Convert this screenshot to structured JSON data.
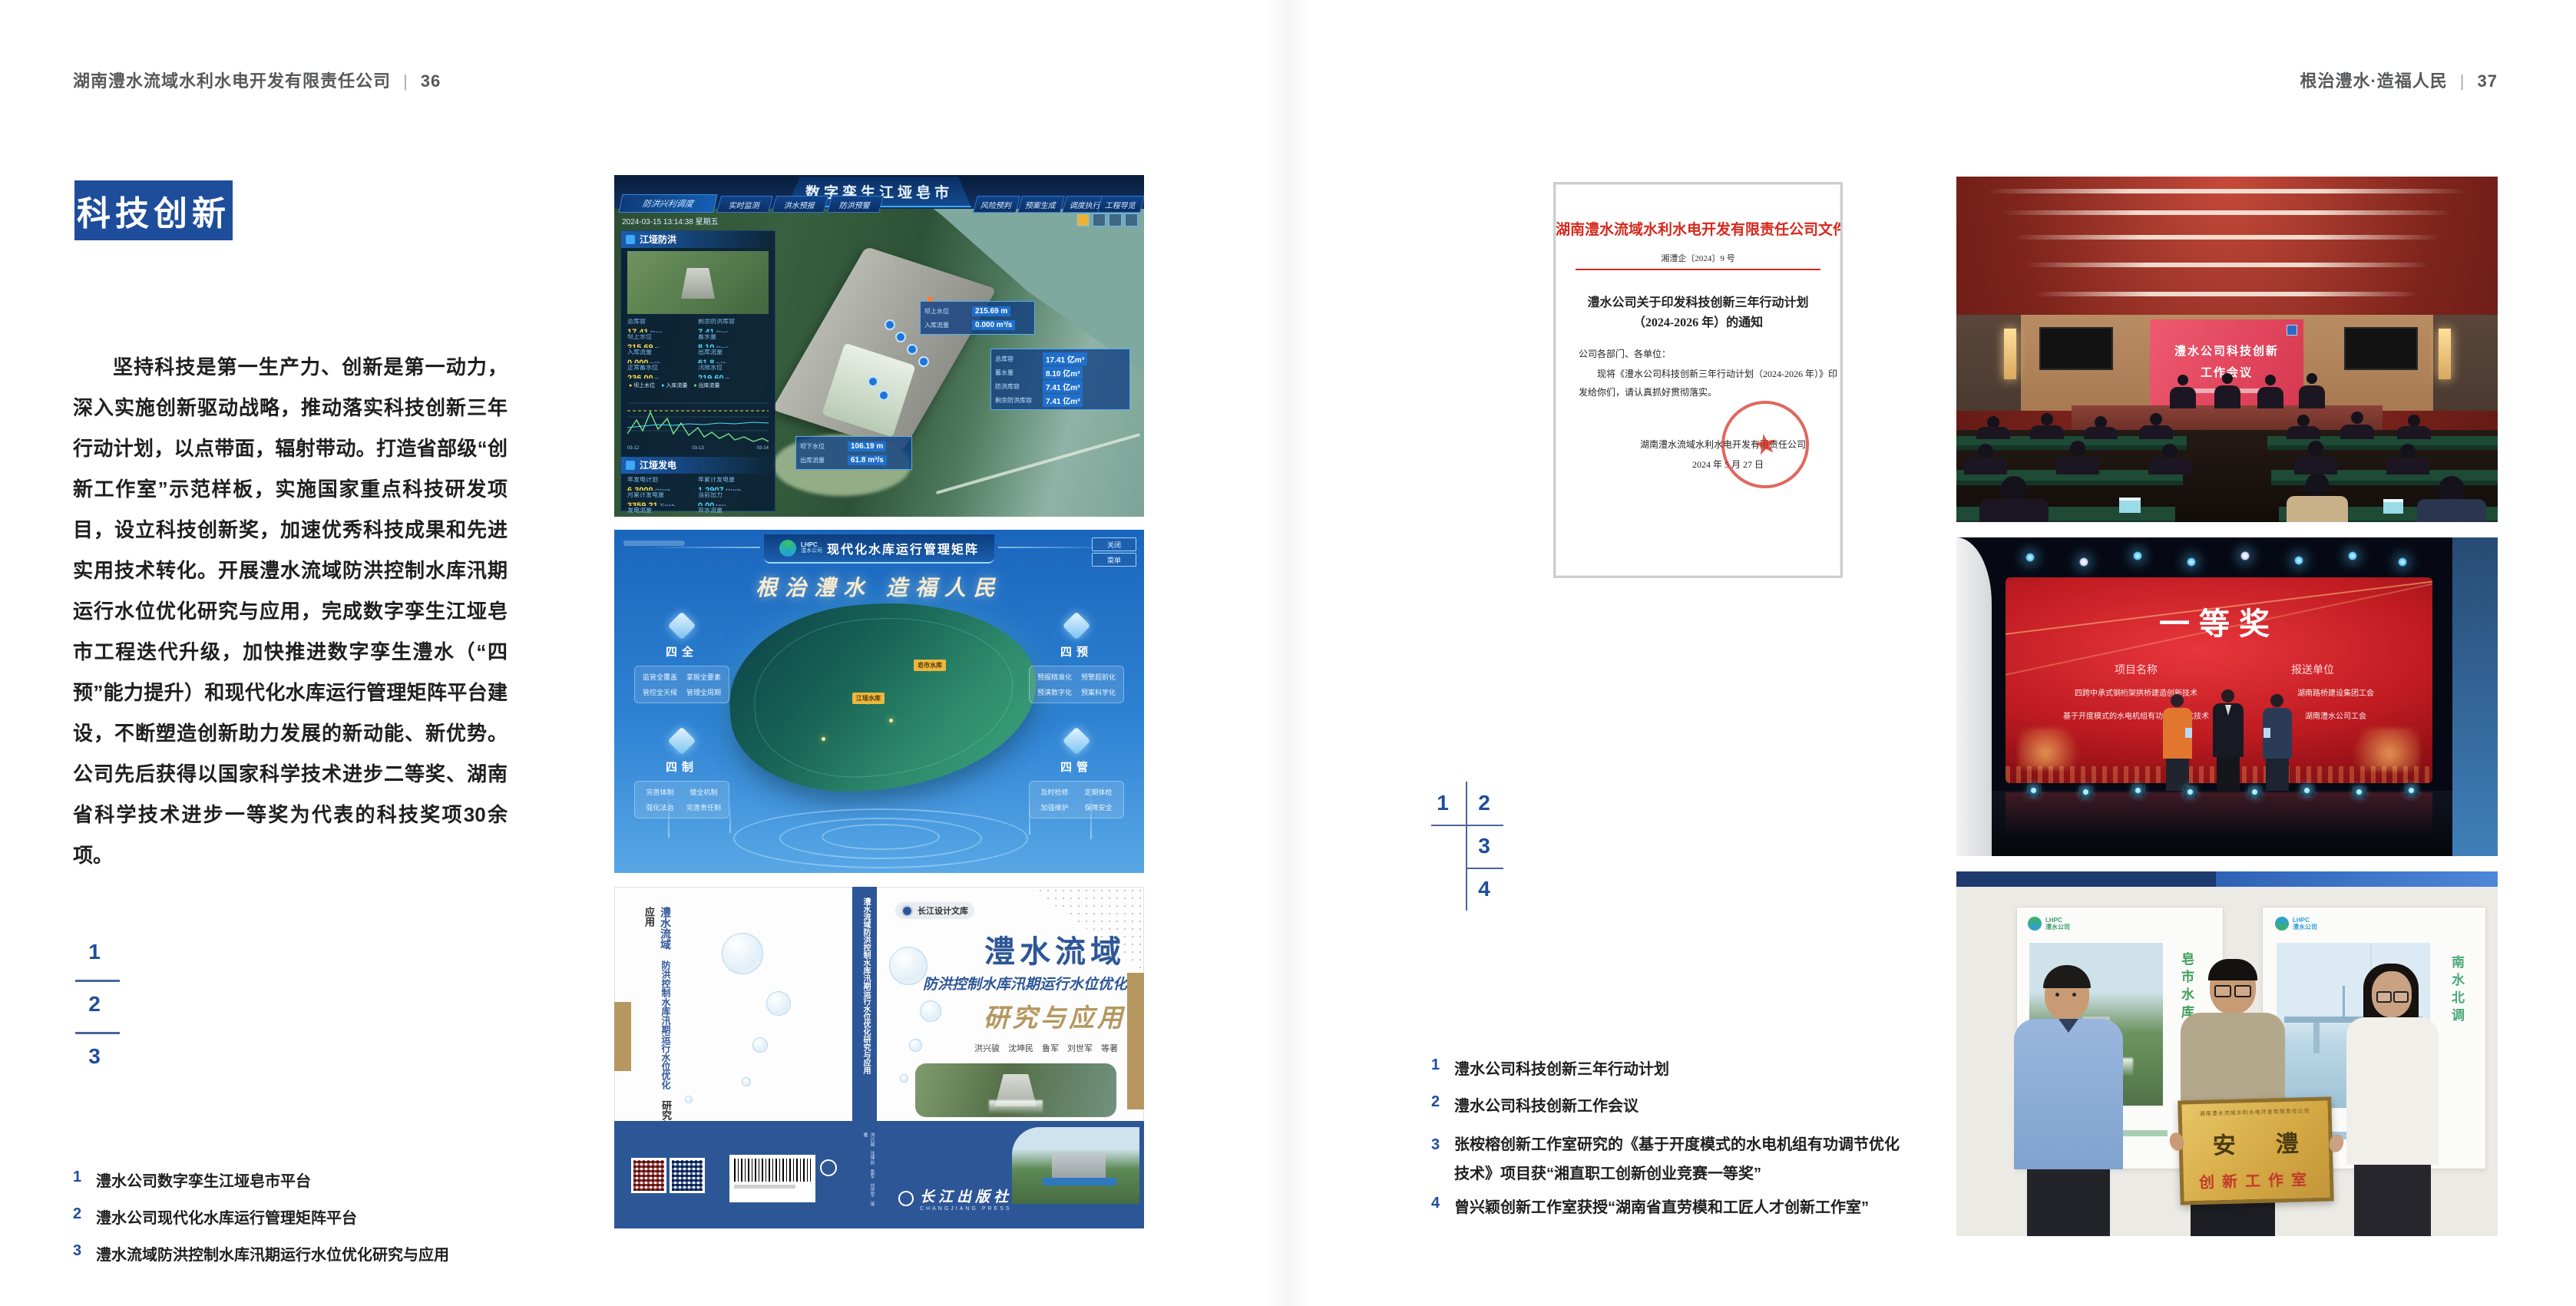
{
  "colors": {
    "accent_blue": "#1e4d9b",
    "header_gray": "#57585a",
    "doc_red": "#d6281c",
    "book_blue": "#2d5697",
    "book_tan": "#b5975f"
  },
  "header_left": {
    "company": "湖南澧水流域水利水电开发有限责任公司",
    "divider": "|",
    "page": "36"
  },
  "header_right": {
    "motto": "根治澧水·造福人民",
    "divider": "|",
    "page": "37"
  },
  "badge": "科技创新",
  "intro": "坚持科技是第一生产力、创新是第一动力，深入实施创新驱动战略，推动落实科技创新三年行动计划，以点带面，辐射带动。打造省部级“创新工作室”示范样板，实施国家重点科技研发项目，设立科技创新奖，加速优秀科技成果和先进实用技术转化。开展澧水流域防洪控制水库汛期运行水位优化研究与应用，完成数字孪生江垭皂市工程迭代升级，加快推进数字孪生澧水（“四预”能力提升）和现代化水库运行管理矩阵平台建设，不断塑造创新助力发展的新动能、新优势。公司先后获得以国家科学技术进步二等奖、湖南省科学技术进步一等奖为代表的科技奖项30余项。",
  "left_index": {
    "n1": "1",
    "n2": "2",
    "n3": "3"
  },
  "left_captions": [
    {
      "num": "1",
      "text": "澧水公司数字孪生江垭皂市平台"
    },
    {
      "num": "2",
      "text": "澧水公司现代化水库运行管理矩阵平台"
    },
    {
      "num": "3",
      "text": "澧水流域防洪控制水库汛期运行水位优化研究与应用"
    }
  ],
  "right_index": {
    "n1": "1",
    "n2": "2",
    "n3": "3",
    "n4": "4"
  },
  "right_captions": [
    {
      "num": "1",
      "text": "澧水公司科技创新三年行动计划"
    },
    {
      "num": "2",
      "text": "澧水公司科技创新工作会议"
    },
    {
      "num": "3",
      "text": "张桉榕创新工作室研究的《基于开度模式的水电机组有功调节优化技术》项目获“湘直职工创新创业竞赛一等奖”"
    },
    {
      "num": "4",
      "text": "曾兴颖创新工作室获授“湖南省直劳模和工匠人才创新工作室”"
    }
  ],
  "dashboard": {
    "title": "数字孪生江垭皂市",
    "nav_active": "防洪兴利调度",
    "tabs_left": [
      "实时监测",
      "洪水预报",
      "防洪预警"
    ],
    "tabs_right": [
      "风险预判",
      "预案生成",
      "调度执行",
      "工程导览"
    ],
    "timestamp": "2024-03-15 13:14:38 星期五",
    "flood_panel": {
      "title": "江垭防洪",
      "stats": [
        {
          "l": "总库容",
          "v": "17.41",
          "u": "亿m³"
        },
        {
          "l": "剩余防洪库容",
          "v": "7.41",
          "u": "亿m³"
        },
        {
          "l": "坝上水位",
          "v": "215.69",
          "u": "m"
        },
        {
          "l": "蓄水量",
          "v": "8.10",
          "u": "亿m³"
        },
        {
          "l": "入库流量",
          "v": "0.000",
          "u": "m³/s"
        },
        {
          "l": "出库流量",
          "v": "61.8",
          "u": "m³/s"
        },
        {
          "l": "正常蓄水位",
          "v": "236.00",
          "u": "m"
        },
        {
          "l": "汛限水位",
          "v": "219.60",
          "u": "m"
        }
      ],
      "legend": [
        "坝上水位",
        "入库流量",
        "出库流量"
      ],
      "x_ticks": [
        "03-12",
        "03-13",
        "03-14"
      ]
    },
    "power_panel": {
      "title": "江垭发电",
      "stats": [
        {
          "l": "年发电计划",
          "v": "6.3000",
          "u": "亿kWh"
        },
        {
          "l": "年累计发电量",
          "v": "1.2907",
          "u": "亿kWh"
        },
        {
          "l": "月累计发电量",
          "v": "3359.21",
          "u": "万kWh"
        },
        {
          "l": "当前出力",
          "v": "0.00",
          "u": "MW"
        },
        {
          "l": "发电流量",
          "v": "0.00",
          "u": "m³/s"
        },
        {
          "l": "弃水流量",
          "v": "0.00",
          "u": "m³/s"
        }
      ],
      "gauges": [
        "0.00",
        "102.98",
        "0.00"
      ]
    },
    "callout_up": {
      "rows": [
        {
          "l": "坝上水位",
          "v": "215.69 m"
        },
        {
          "l": "入库流量",
          "v": "0.000 m³/s"
        }
      ]
    },
    "callout_res": {
      "rows": [
        {
          "l": "总库容",
          "v": "17.41 亿m³"
        },
        {
          "l": "蓄水量",
          "v": "8.10 亿m³"
        },
        {
          "l": "防洪库容",
          "v": "7.41 亿m³"
        },
        {
          "l": "剩余防洪库容",
          "v": "7.41 亿m³"
        }
      ]
    },
    "callout_down": {
      "rows": [
        {
          "l": "坝下水位",
          "v": "106.19 m"
        },
        {
          "l": "出库流量",
          "v": "61.8 m³/s"
        }
      ]
    }
  },
  "matrix": {
    "logo_top": "LHPC",
    "logo_bottom": "澧水公司",
    "title": "现代化水库运行管理矩阵",
    "slogan": "根治澧水  造福人民",
    "btn_close": "关闭",
    "btn_menu": "菜单",
    "panels": [
      {
        "name": "四全",
        "items": [
          "监管全覆盖",
          "掌握全要素",
          "管控全天候",
          "管理全周期"
        ]
      },
      {
        "name": "四预",
        "items": [
          "预报精准化",
          "预警超前化",
          "预演数字化",
          "预案科学化"
        ]
      },
      {
        "name": "四制",
        "items": [
          "完善体制",
          "健全机制",
          "强化法治",
          "完善责任制"
        ]
      },
      {
        "name": "四管",
        "items": [
          "及时检修",
          "定期体检",
          "加强维护",
          "保障安全"
        ]
      }
    ],
    "marker_1": "皂市水库",
    "marker_2": "江垭水库"
  },
  "book": {
    "series": "长江设计文库",
    "back_line1": "澧水流域",
    "back_line2": "防洪控制水库汛期运行水位优化",
    "back_line3": "研究与应用",
    "spine_title": "澧水流域防洪控制水库汛期运行水位优化研究与应用",
    "spine_authors": "洪兴骏 沈坤民 鲁军 刘世军 等著",
    "title_main": "澧水流域",
    "title_sub": "防洪控制水库汛期运行水位优化",
    "title_tail": "研究与应用",
    "authors": "洪兴骏　沈坤民　鲁军　刘世军　等著",
    "publisher": "长江出版社",
    "publisher_en": "CHANGJIANG PRESS"
  },
  "doc": {
    "header": "湖南澧水流域水利水电开发有限责任公司文件",
    "doc_no": "湘澧企〔2024〕9 号",
    "title_1": "澧水公司关于印发科技创新三年行动计划",
    "title_2": "（2024-2026 年）的通知",
    "salute": "公司各部门、各单位：",
    "body_1": "现将《澧水公司科技创新三年行动计划（2024-2026 年）》印",
    "body_2": "发给你们，请认真抓好贯彻落实。",
    "signer": "湖南澧水流域水利水电开发有限责任公司",
    "date": "2024 年 5 月 27 日"
  },
  "meeting": {
    "line1": "澧水公司科技创新",
    "line2": "工作会议"
  },
  "award": {
    "title": "一等奖",
    "col1_header": "项目名称",
    "col2_header": "报送单位",
    "col1": [
      "四跨中承式钢桁架拱桥建造创新技术",
      "基于开度模式的水电机组有功调节优化技术"
    ],
    "col2": [
      "湖南路桥建设集团工会",
      "湖南澧水公司工会"
    ]
  },
  "workshop": {
    "plaque_org": "湖南澧水流域水利水电开发有限责任公司",
    "plaque_char1": "安",
    "plaque_char2": "澧",
    "plaque_sub": "创新工作室",
    "poster_left_logo_1": "LHPC",
    "poster_left_logo_2": "澧水公司",
    "poster_left_title": "皂市水库",
    "poster_right_logo_1": "LHPC",
    "poster_right_logo_2": "澧水公司",
    "poster_right_title": "南水北调"
  }
}
